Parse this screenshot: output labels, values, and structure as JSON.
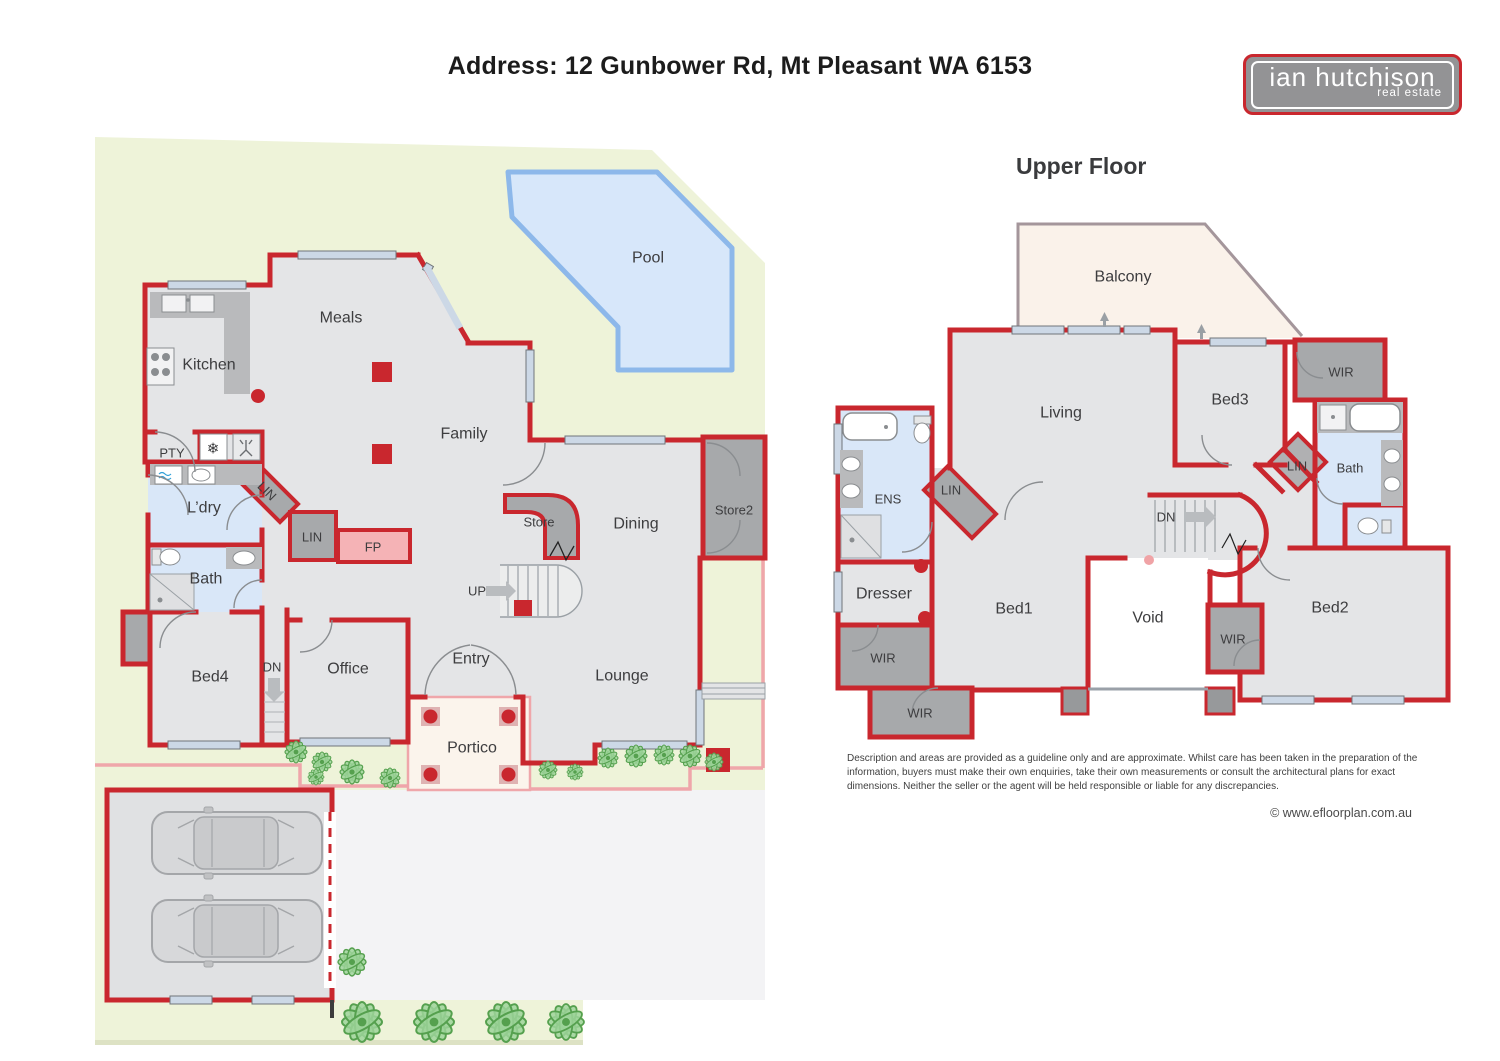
{
  "header": {
    "title": "Address: 12 Gunbower Rd, Mt Pleasant WA 6153",
    "logo": {
      "name": "ian hutchison",
      "tagline": "real estate"
    }
  },
  "lower_floor": {
    "heading": "Lower Floor",
    "labels": {
      "pool": "Pool",
      "meals": "Meals",
      "kitchen": "Kitchen",
      "family": "Family",
      "pty": "PTY",
      "ldry": "L’dry",
      "lin_hall": "LIN",
      "lin_closet": "LIN",
      "fp": "FP",
      "store": "Store",
      "dining": "Dining",
      "store2": "Store2",
      "up": "UP",
      "bath": "Bath",
      "bed4": "Bed4",
      "dn": "DN",
      "office": "Office",
      "entry": "Entry",
      "lounge": "Lounge",
      "portico": "Portico"
    }
  },
  "upper_floor": {
    "heading": "Upper Floor",
    "labels": {
      "balcony": "Balcony",
      "living": "Living",
      "bed3": "Bed3",
      "wir_top": "WIR",
      "ens": "ENS",
      "lin_left": "LIN",
      "lin_right": "LIN",
      "bath": "Bath",
      "dn": "DN",
      "dresser": "Dresser",
      "bed1": "Bed1",
      "void": "Void",
      "bed2": "Bed2",
      "wir_left": "WIR",
      "wir_mid": "WIR",
      "wir_bottom": "WIR"
    }
  },
  "footer": {
    "disclaimer": "Description and areas are provided as a guideline only and are approximate. Whilst care has been taken in the preparation of the information, buyers must make their own enquiries, take their own measurements or consult the architectural plans for exact dimensions. Neither the seller or the agent will be held responsible or liable for any discrepancies.",
    "copyright": "© www.efloorplan.com.au"
  },
  "colors": {
    "wall": "#c9272e",
    "floor": "#e4e5e7",
    "lot": "#eef3d9",
    "pool": "#d7e7fa",
    "pool_border": "#8db8ea",
    "wet_area": "#d9e7f8",
    "storage": "#a7a9ab",
    "fireplace": "#f5b3b6",
    "portico": "#fbf4ec",
    "balcony": "#faf2ea"
  }
}
